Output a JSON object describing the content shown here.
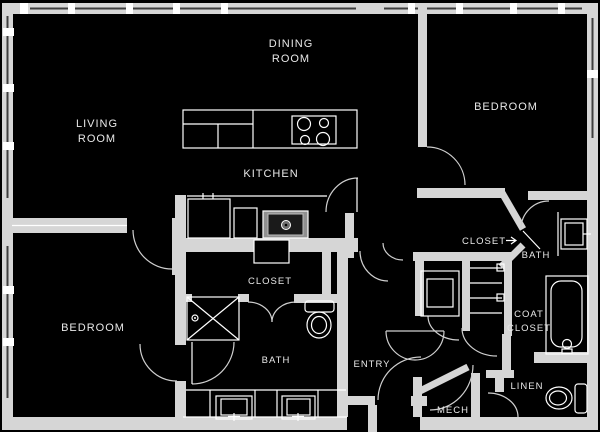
{
  "meta": {
    "kind": "apartment-floor-plan",
    "background": "#000000"
  },
  "colors": {
    "wall": "#d6d6d6",
    "fixture_line": "#ffffff",
    "door_arc": "#cfcfcf",
    "label_text": "#e8e8e8",
    "sink_fill": "#909090"
  },
  "rooms": {
    "dining": {
      "line1": "DINING",
      "line2": "ROOM"
    },
    "living": {
      "line1": "LIVING",
      "line2": "ROOM"
    },
    "bedroom_top": {
      "label": "BEDROOM"
    },
    "kitchen": {
      "label": "KITCHEN"
    },
    "closet_main": {
      "label": "CLOSET"
    },
    "bath_main": {
      "label": "BATH"
    },
    "bedroom_left": {
      "label": "BEDROOM"
    },
    "closet_second": {
      "label": "CLOSET"
    },
    "bath_second": {
      "label": "BATH"
    },
    "coat_closet": {
      "line1": "COAT",
      "line2": "CLOSET"
    },
    "linen": {
      "label": "LINEN"
    },
    "mech": {
      "label": "MECH"
    },
    "entry": {
      "label": "ENTRY"
    }
  }
}
